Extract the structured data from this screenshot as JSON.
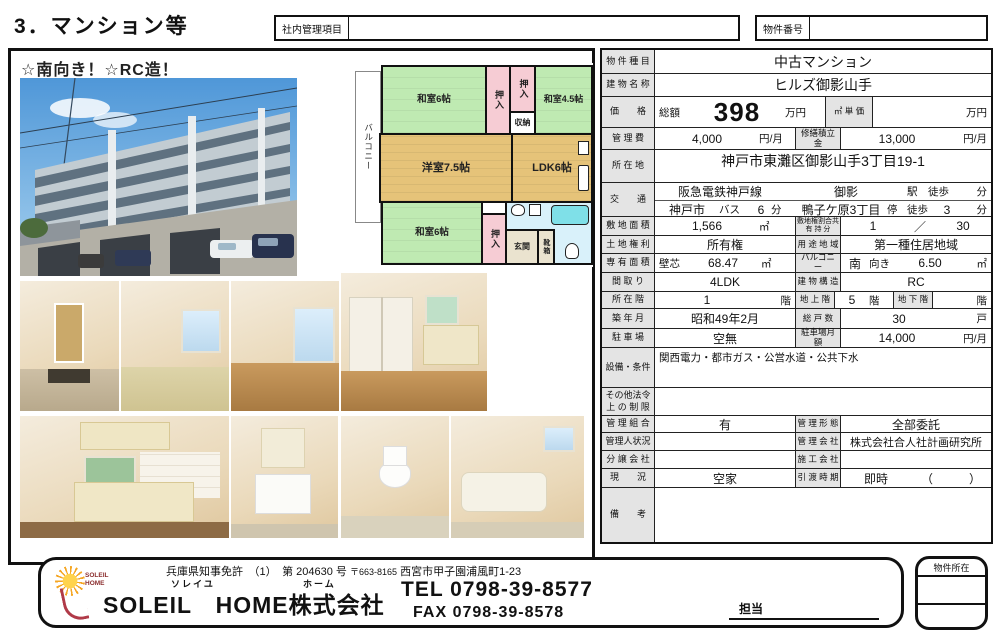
{
  "page_title": "3．マンション等",
  "header": {
    "internal_mgmt_label": "社内管理項目",
    "property_number_label": "物件番号"
  },
  "photo_panel": {
    "headline": "☆南向き！☆RC造！"
  },
  "floorplan": {
    "balcony": "バルコニー",
    "washitsu_top": "和室6帖",
    "oshiire_1": "押入",
    "oshiire_2": "押入",
    "storage": "収納",
    "washitsu_45": "和室4.5帖",
    "yoshitsu": "洋室7.5帖",
    "ldk": "LDK6帖",
    "washitsu_bottom": "和室6帖",
    "oshiire_3": "押入",
    "genkan": "玄関",
    "shoebox": "靴箱"
  },
  "table": {
    "property_type": {
      "label": "物 件 種 目",
      "value": "中古マンション"
    },
    "building_name": {
      "label": "建 物 名 称",
      "value": "ヒルズ御影山手"
    },
    "price": {
      "label": "価　　格",
      "total_label": "総額",
      "value": "398",
      "unit": "万円",
      "sqm_label": "㎡ 単 価",
      "sqm_unit": "万円"
    },
    "mgmt_fee": {
      "label": "管 理 費",
      "value": "4,000",
      "unit": "円/月",
      "repair_label": "修繕積立金",
      "repair_value": "13,000",
      "repair_unit": "円/月"
    },
    "location": {
      "label": "所 在 地",
      "value": "神戸市東灘区御影山手3丁目19-1"
    },
    "transport": {
      "label": "交　　通",
      "rail": "阪急電鉄神戸線",
      "station": "御影",
      "walk1": "駅　徒歩",
      "min1": "分",
      "city": "神戸市",
      "bus": "バス",
      "bus_min": "6",
      "min2": "分",
      "stop": "鴨子ケ原3丁目",
      "stop_suffix": "停",
      "walk2": "徒歩",
      "walk2_min": "3",
      "min3": "分"
    },
    "land_area": {
      "label": "敷 地 面 積",
      "value": "1,566",
      "unit": "㎡",
      "share_label1": "敷地権割合共",
      "share_label2": "有 持 分",
      "share_num": "1",
      "share_slash": "／",
      "share_den": "30"
    },
    "land_right": {
      "label": "土 地 権 利",
      "value": "所有権",
      "zone_label": "用 途 地 域",
      "zone_value": "第一種住居地域"
    },
    "exclusive_area": {
      "label": "専 有 面 積",
      "method": "壁芯",
      "value": "68.47",
      "unit": "㎡",
      "balcony_label": "バルコニー",
      "balcony_dir": "南",
      "balcony_facing": "向き",
      "balcony_value": "6.50",
      "balcony_unit": "㎡"
    },
    "layout": {
      "label": "間 取 り",
      "value": "4LDK",
      "structure_label": "建 物 構 造",
      "structure_value": "RC"
    },
    "floor": {
      "label": "所 在 階",
      "value": "1",
      "unit": "階",
      "above_label": "地 上 階",
      "above_value": "5",
      "above_unit": "階",
      "below_label": "地 下 階",
      "below_unit": "階"
    },
    "built": {
      "label": "築 年 月",
      "value": "昭和49年2月",
      "units_label": "総 戸 数",
      "units_value": "30",
      "units_unit": "戸"
    },
    "parking": {
      "label": "駐 車 場",
      "value": "空無",
      "monthly_label": "駐車場月額",
      "monthly_value": "14,000",
      "monthly_unit": "円/月"
    },
    "facilities": {
      "label": "設備・条件",
      "value": "関西電力・都市ガス・公営水道・公共下水"
    },
    "other_restrictions": {
      "label1": "その他法令",
      "label2": "上 の 制 限"
    },
    "association": {
      "label": "管 理 組 合",
      "value": "有",
      "form_label": "管 理 形 態",
      "form_value": "全部委託"
    },
    "manager": {
      "label": "管理人状況",
      "company_label": "管 理 会 社",
      "company_value": "株式会社合人社計画研究所"
    },
    "developer": {
      "label": "分 譲 会 社",
      "builder_label": "施 工 会 社"
    },
    "status": {
      "label": "現　　況",
      "value": "空家",
      "handover_label": "引 渡 時 期",
      "handover_value": "即時",
      "handover_paren": "（　　　）"
    },
    "remarks": {
      "label": "備　　考"
    }
  },
  "footer": {
    "license": "兵庫県知事免許　（1）　第 204630 号",
    "postal": "〒663-8165",
    "address": "西宮市甲子園浦風町1-23",
    "furigana_1": "ソレイユ",
    "furigana_2": "ホーム",
    "company": "SOLEIL　HOME株式会社",
    "tel": "TEL 0798-39-8577",
    "fax": "FAX 0798-39-8578",
    "staff_label": "担当",
    "site_box_label": "物件所在",
    "logo_line1": "SOLEIL",
    "logo_line2": "HOME"
  }
}
